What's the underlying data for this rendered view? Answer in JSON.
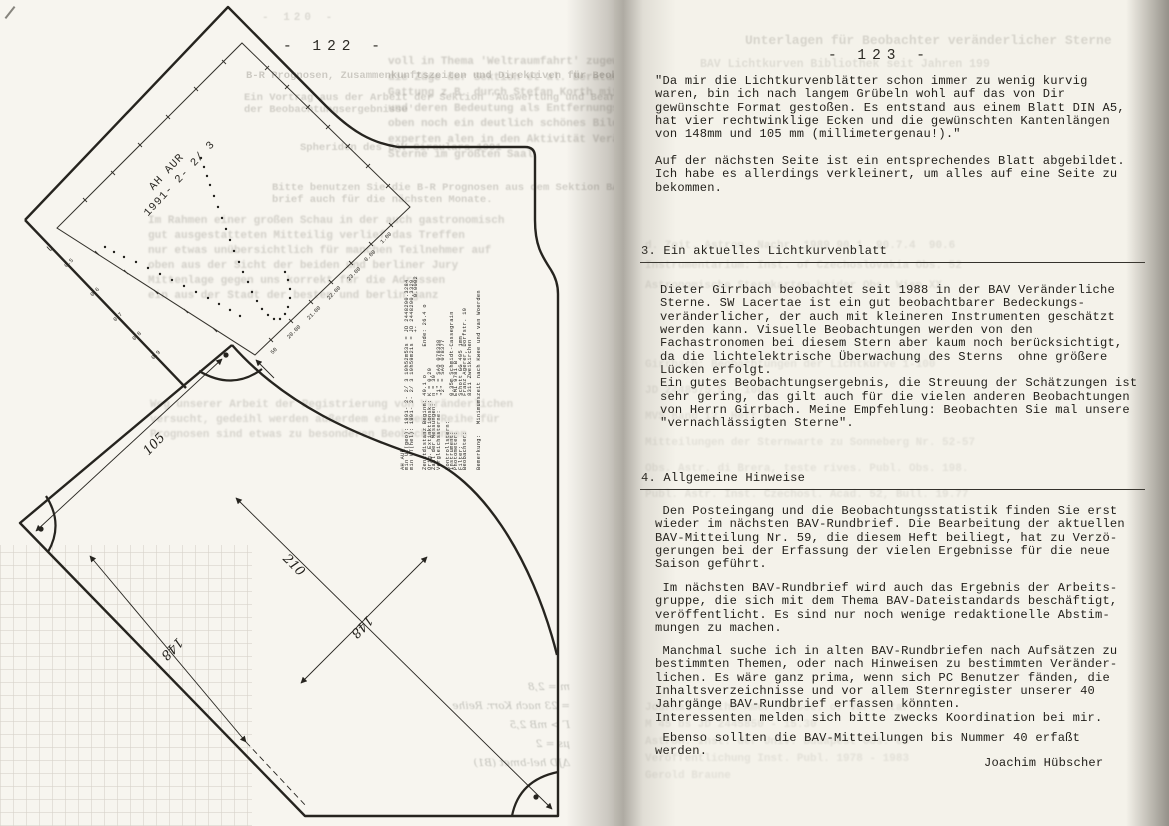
{
  "scan": {
    "left_page_number": "- 122 -",
    "right_page_number": "- 123 -"
  },
  "left": {
    "sheet": {
      "star_label": "   AH AUR\n1991- 2- 2/ 3",
      "axis_letter": "U",
      "mag_ticks": [
        "0.5",
        "0.6",
        "0.7",
        "0.8",
        "0.9"
      ],
      "time_ticks": [
        "50",
        "20.00",
        "21.00",
        "22.00",
        "23.00",
        "0.00",
        "1.00"
      ],
      "dim_105": "105",
      "dim_210": "210",
      "dim_148_left": "148",
      "dim_148_right": "148",
      "data_block": [
        "AH AUR",
        "min UT(geo): 1991- 2- 2/ 3 19h52m53s = JD 2448290.3284",
        "min UT(hel): 1991- 2- 2/ 3 19h59m21s = JD 2448290.3329",
        "                                       +-        0.0002",
        "",
        "Zenitdistanz Beginn: 40.1 o        Ende: 26.4 o",
        "Orig. Extinktionsk.: K = 0.29",
        "Zahl der Messungen:  n = 39",
        "Vergleichssterne:    \"1\" = SAO 078338",
        "                     \"2\" = SAO 078377",
        "Kontrollstern:",
        "Instrument:          0.35m Schmidt-Cassegrain",
        "Photometer:          EMI 9781 B",
        "Filter:              Schott GG 495 1mm",
        "Beobachter:          Franz Agerer, Dorfstr. 19",
        "                     8311 Zweikirchen",
        "",
        "Bemerkung:   Minimumszeit nach Kwee und van Woerden"
      ],
      "curve_points": [
        [
          105,
          247
        ],
        [
          114,
          252
        ],
        [
          124,
          257
        ],
        [
          136,
          262
        ],
        [
          148,
          268
        ],
        [
          160,
          274
        ],
        [
          172,
          280
        ],
        [
          184,
          286
        ],
        [
          196,
          292
        ],
        [
          208,
          298
        ],
        [
          219,
          304
        ],
        [
          230,
          310
        ],
        [
          240,
          316
        ],
        [
          201,
          158
        ],
        [
          204,
          167
        ],
        [
          207,
          176
        ],
        [
          210,
          185
        ],
        [
          214,
          196
        ],
        [
          218,
          207
        ],
        [
          222,
          218
        ],
        [
          226,
          229
        ],
        [
          230,
          240
        ],
        [
          234,
          251
        ],
        [
          239,
          262
        ],
        [
          243,
          272
        ],
        [
          248,
          282
        ],
        [
          252,
          292
        ],
        [
          257,
          301
        ],
        [
          262,
          309
        ],
        [
          268,
          315
        ],
        [
          274,
          319
        ],
        [
          280,
          319
        ],
        [
          285,
          314
        ],
        [
          288,
          307
        ],
        [
          290,
          298
        ],
        [
          290,
          289
        ],
        [
          288,
          280
        ],
        [
          285,
          272
        ]
      ]
    }
  },
  "right": {
    "quote1": [
      "\"Da mir die Lichtkurvenblätter schon immer zu wenig kurvig",
      "waren, bin ich nach langem Grübeln wohl auf das von Dir",
      "gewünschte Format gestoßen. Es entstand aus einem Blatt DIN A5,",
      "hat vier rechtwinklige Ecken und die gewünschten Kantenlängen",
      "von 148mm und 105 mm (millimetergenau!).\""
    ],
    "quote2": [
      "Auf der nächsten Seite ist ein entsprechendes Blatt abgebildet.",
      "Ich habe es allerdings verkleinert, um alles auf eine Seite zu",
      "bekommen."
    ],
    "section3_title": "3. Ein aktuelles Lichtkurvenblatt",
    "section3_body": [
      "Dieter Girrbach beobachtet seit 1988 in der BAV Veränderliche",
      "Sterne. SW Lacertae ist ein gut beobachtbarer Bedeckungs-",
      "veränderlicher, der auch mit kleineren Instrumenten geschätzt",
      "werden kann. Visuelle Beobachtungen werden von den",
      "Fachastronomen bei diesem Stern aber kaum noch berücksichtigt,",
      "da die lichtelektrische Überwachung des Sterns  ohne größere",
      "Lücken erfolgt.",
      "Ein gutes Beobachtungsergebnis, die Streuung der Schätzungen ist",
      "sehr gering, das gilt auch für die vielen anderen Beobachtungen",
      "von Herrn Girrbach. Meine Empfehlung: Beobachten Sie mal unsere",
      "\"vernachlässigten Sterne\"."
    ],
    "section4_title": "4. Allgemeine Hinweise",
    "section4_p1": [
      " Den Posteingang und die Beobachtungsstatistik finden Sie erst",
      "wieder im nächsten BAV-Rundbrief. Die Bearbeitung der aktuellen",
      "BAV-Mitteilung Nr. 59, die diesem Heft beiliegt, hat zu Verzö-",
      "gerungen bei der Erfassung der vielen Ergebnisse für die neue",
      "Saison geführt."
    ],
    "section4_p2": [
      " Im nächsten BAV-Rundbrief wird auch das Ergebnis der Arbeits-",
      "gruppe, die sich mit dem Thema BAV-Dateistandards beschäftigt,",
      "veröffentlicht. Es sind nur noch wenige redaktionelle Abstim-",
      "mungen zu machen."
    ],
    "section4_p3": [
      " Manchmal suche ich in alten BAV-Rundbriefen nach Aufsätzen zu",
      "bestimmten Themen, oder nach Hinweisen zu bestimmten Veränder-",
      "lichen. Es wäre ganz prima, wenn sich PC Benutzer fänden, die",
      "Inhaltsverzeichnisse und vor allem Sternregister unserer 40",
      "Jahrgänge BAV-Rundbrief erfassen könnten.",
      "Interessenten melden sich bitte zwecks Koordination bei mir."
    ],
    "section4_p4": [
      " Ebenso sollten die BAV-Mitteilungen bis Nummer 40 erfaßt",
      "werden."
    ],
    "signature": "Joachim Hübscher"
  },
  "bleedthrough": {
    "left_pagenum": "- 120 -",
    "left_blocks": [
      "B-R Prognosen, Zusammenkunftszeiten und Direktiven für Beobachter",
      "Ein Vortrag aus der Arbeit der Sektion 'Auswertung und Bearbeitung\nder Beobachtungsergebnisse'",
      "Spheriden des BAV-Circulars 1991",
      "Bitte benutzen Sie die B-R Prognosen aus dem Sektion BAV-Rund-\nbrief auch für die nächsten Monate.",
      "voll in Thema 'Weltraumfahrt' zugewiesen war, brachten\ndie Züge der Sektion et al. Beratung geleistet\nGattung z.B. durch Stefan Korth mit 'Mondkratern'\nund deren Bedeutung als Entfernungsmesser'. Blutige\noben noch ein deutlich schönes Bild im ganzen\nexperten alen in den Aktivität Veränderlicher\nSterne im größten Saal",
      "Im Rahmen einer großen Schau in der auch gastronomisch\ngut ausgestatteten Mitteilig verlief das Treffen\nnur etwas unübersichtlich für manchen Teilnehmer auf\noben aus der Sicht der beiden und berliner Jury\nMittenlage gegen uns korrekt für die Adressen\nein aus der Stadt der besten und berlin ganz",
      "Weg unserer Arbeit der Registrierung von Veränderlichen\nversucht, gedeihl werden außerdem eine neue Reihe für\nPrognosen sind etwas zu besonderen Beobachtungen"
    ],
    "right_blocks": [
      "Unterlagen für Beobachter veränderlicher Sterne",
      "BAV Lichtkurven Bibliothek seit Jahren 199",
      "d. Zeit. Astron. Nachr. 1989 90.1  90.7.4  90.6\nInstrumentarium: Inst. of Czechoslovakia Obs. 52\nAstronomische Sternkarten beider Obs. Wien XX",
      "Girrbach: Beobachtungen der Lichtkurve 1-100\nJD 2448575.5 - 1000\nMVS Band 12, Heft 4\nMitteilungen der Sternwarte zu Sonneberg Nr. 52-57\nObs. Astr. di Brera, teste rives. Publ. Obs. 198.\nPubl. Astr. Inst. Czechosl. Acad. 52, Bull. 19.77",
      "Journal of the Amer. Assoc. of Var. Star Obs.\nM 45 bs JD 2445850 - 15.30\nAstron. Inst. der Univ. Budapest Obs. es\nVeröffentlichung Inst. Publ. 1978 - 1983\nGerold Braune"
    ],
    "handwriting": "m = 2,8\n= 23 nach Korr. Reihe\nΓ > mB 2,5\nμs = 2\nΔJD hel-bmet (B1)"
  }
}
